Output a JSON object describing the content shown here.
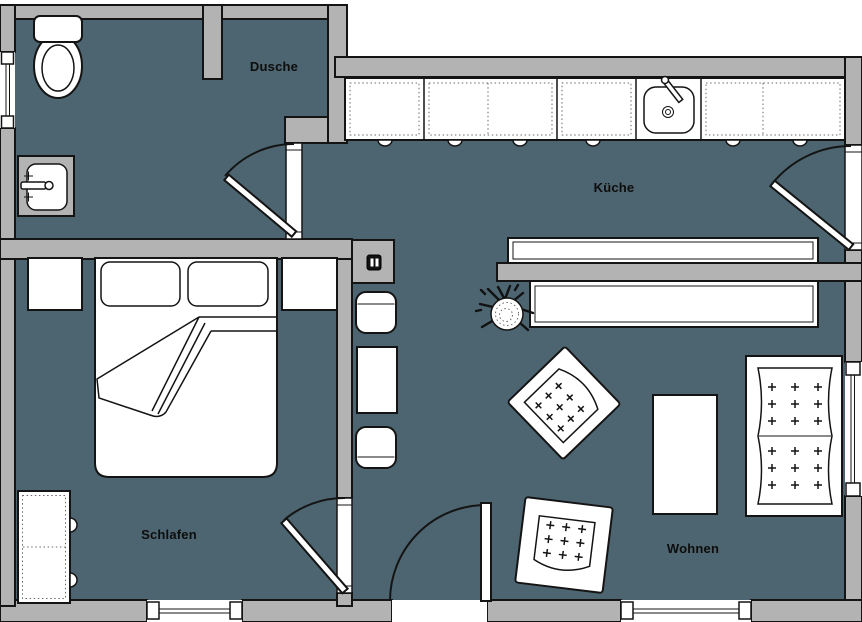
{
  "plan": {
    "type": "apartment-floor-plan",
    "rooms": [
      {
        "id": "dusche",
        "label": "Dusche"
      },
      {
        "id": "kueche",
        "label": "Küche"
      },
      {
        "id": "schlafen",
        "label": "Schlafen"
      },
      {
        "id": "wohnen",
        "label": "Wohnen"
      }
    ],
    "fixtures": {
      "bathroom": [
        "toilet",
        "washbasin",
        "shower-partition"
      ],
      "kitchen": [
        "cabinet-run",
        "kitchen-sink",
        "counter",
        "sideboard",
        "plant"
      ],
      "hallway": [
        "shaft-box",
        "dining-chair",
        "dining-table",
        "dining-chair"
      ],
      "bedroom": [
        "nightstand",
        "double-bed",
        "pillow",
        "pillow",
        "nightstand",
        "wardrobe"
      ],
      "living": [
        "armchair",
        "armchair",
        "coffee-table",
        "sofa"
      ],
      "openings": [
        "bathroom-door",
        "balcony-door",
        "bedroom-door",
        "entrance-door",
        "window-left",
        "window-right",
        "window-bottom-1",
        "window-bottom-2"
      ]
    }
  },
  "colors": {
    "floor": "#4d6570",
    "wall": "#b3b3b3",
    "outline": "#141414",
    "fill": "#ffffff",
    "label": "#0d0d0d"
  }
}
